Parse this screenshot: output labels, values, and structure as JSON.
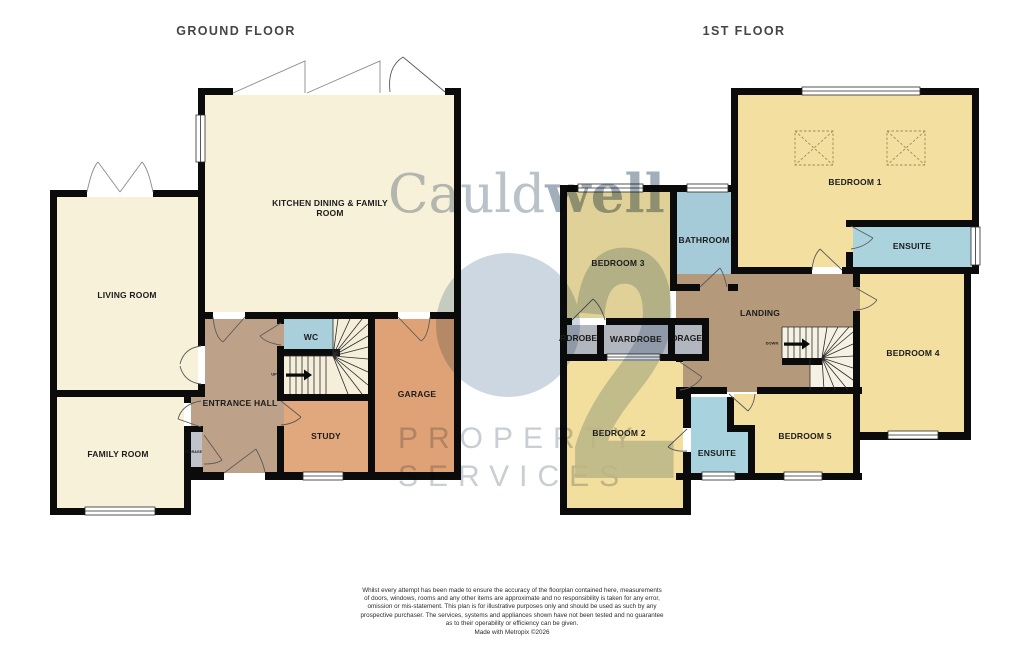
{
  "titles": {
    "ground_floor": "GROUND FLOOR",
    "first_floor": "1ST FLOOR"
  },
  "ground_floor": {
    "rooms": {
      "kitchen": "KITCHEN DINING & FAMILY\nROOM",
      "living_room": "LIVING ROOM",
      "family_room": "FAMILY ROOM",
      "entrance_hall": "ENTRANCE HALL",
      "wc": "WC",
      "study": "STUDY",
      "garage": "GARAGE",
      "storage": "STORAGE"
    },
    "stair_direction": "UP"
  },
  "first_floor": {
    "rooms": {
      "bedroom_1": "BEDROOM 1",
      "bedroom_2": "BEDROOM 2",
      "bedroom_3": "BEDROOM 3",
      "bedroom_4": "BEDROOM 4",
      "bedroom_5": "BEDROOM 5",
      "bathroom": "BATHROOM",
      "ensuite_top": "ENSUITE",
      "ensuite_bottom": "ENSUITE",
      "landing": "LANDING",
      "wardrobe_left": "WARDROBE",
      "wardrobe_center": "WARDROBE",
      "storage": "STORAGE"
    },
    "stair_direction": "DOWN"
  },
  "watermark": {
    "brand_regular": "Cauld",
    "brand_bold": "well",
    "tagline_line1": "PROPERTY",
    "tagline_line2": "SERVICES",
    "monogram_digit": "2"
  },
  "disclaimer": {
    "text": "Whilst every attempt has been made to ensure the accuracy of the floorplan contained here, measurements\nof doors, windows, rooms and any other items are approximate and no responsibility is taken for any error,\nomission or mis-statement. This plan is for illustrative purposes only and should be used as such by any\nprospective purchaser. The services, systems and appliances shown have not been tested and no guarantee\nas to their operability or efficiency can be given.",
    "credit": "Made with Metropix ©2026"
  },
  "colors": {
    "wall": "#0b0b0b",
    "cream_room": "#f7f1da",
    "bedroom_yellow": "#f3e0a0",
    "bedroom3_yellow": "#dfd197",
    "hall_brown": "#bda289",
    "landing_brown": "#b49a7b",
    "study_orange": "#e2a87d",
    "garage_orange": "#dfa276",
    "bath_blue": "#a8cfda",
    "closet_gray": "#b2b6be",
    "watermark_blue": "#cdd7e1"
  }
}
